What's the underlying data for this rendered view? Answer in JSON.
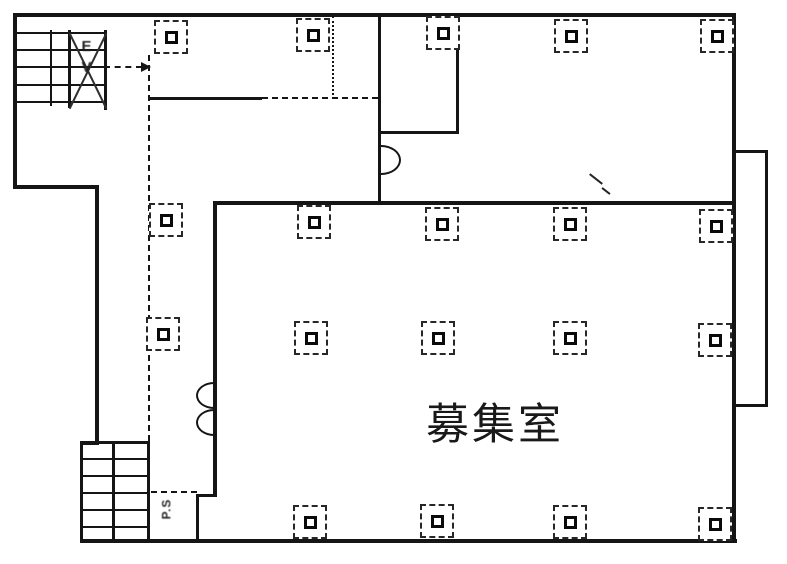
{
  "page": {
    "background": "#ffffff",
    "ink": "#1a1a1a"
  },
  "plan": {
    "room_label": "募集室",
    "elevator_label": "EV",
    "shaft_label": "P.S"
  },
  "column_grid": {
    "marker_style": "dashed square with solid inner square (structural column)",
    "positions": [
      {
        "x": 171,
        "y": 37
      },
      {
        "x": 313,
        "y": 35
      },
      {
        "x": 443,
        "y": 33
      },
      {
        "x": 571,
        "y": 36
      },
      {
        "x": 717,
        "y": 36
      },
      {
        "x": 166,
        "y": 220
      },
      {
        "x": 314,
        "y": 222
      },
      {
        "x": 442,
        "y": 224
      },
      {
        "x": 570,
        "y": 224
      },
      {
        "x": 716,
        "y": 226
      },
      {
        "x": 163,
        "y": 334
      },
      {
        "x": 311,
        "y": 338
      },
      {
        "x": 438,
        "y": 338
      },
      {
        "x": 570,
        "y": 338
      },
      {
        "x": 715,
        "y": 340
      },
      {
        "x": 310,
        "y": 522
      },
      {
        "x": 437,
        "y": 521
      },
      {
        "x": 570,
        "y": 522
      },
      {
        "x": 715,
        "y": 524
      }
    ]
  }
}
